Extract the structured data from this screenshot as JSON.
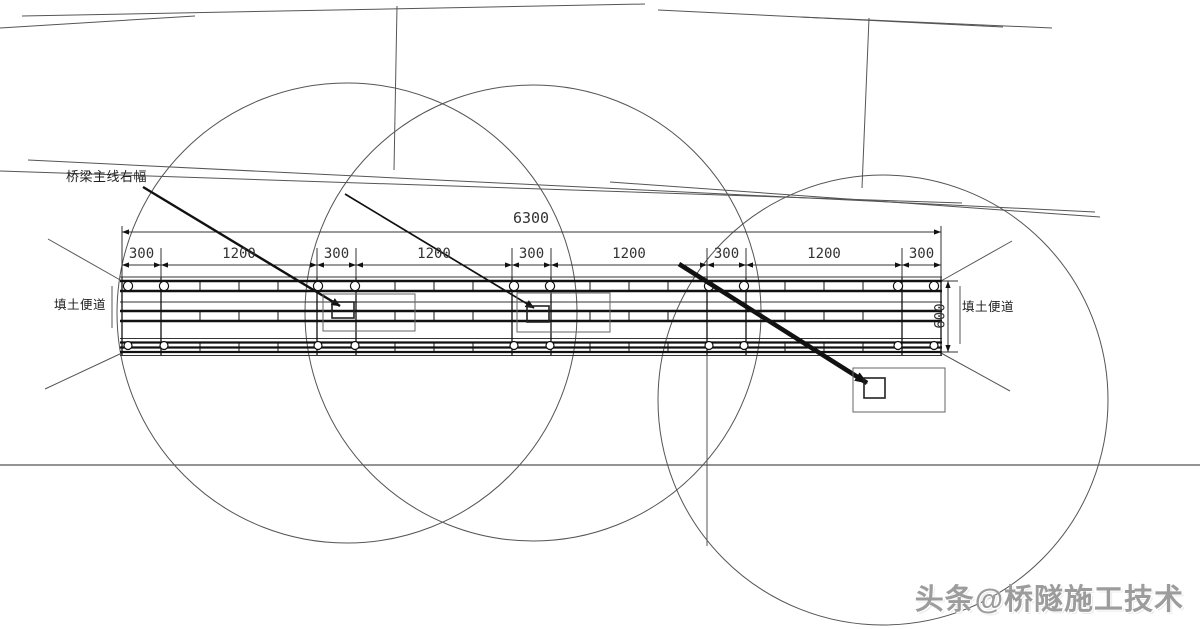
{
  "labels": {
    "bridge_main_line": "桥梁主线右幅",
    "access_road_left": "填土便道",
    "access_road_right": "填土便道"
  },
  "dimensions": {
    "total_length": "6300",
    "segments": [
      "300",
      "1200",
      "300",
      "1200",
      "300",
      "1200",
      "300",
      "1200",
      "300"
    ],
    "beam_height": "600"
  },
  "watermark": "头条@桥隧施工技术",
  "colors": {
    "construction_line": "#555555",
    "beam_line": "#111111",
    "dimension_line": "#333333",
    "watermark": "#9c9c9c",
    "background": "#ffffff"
  }
}
